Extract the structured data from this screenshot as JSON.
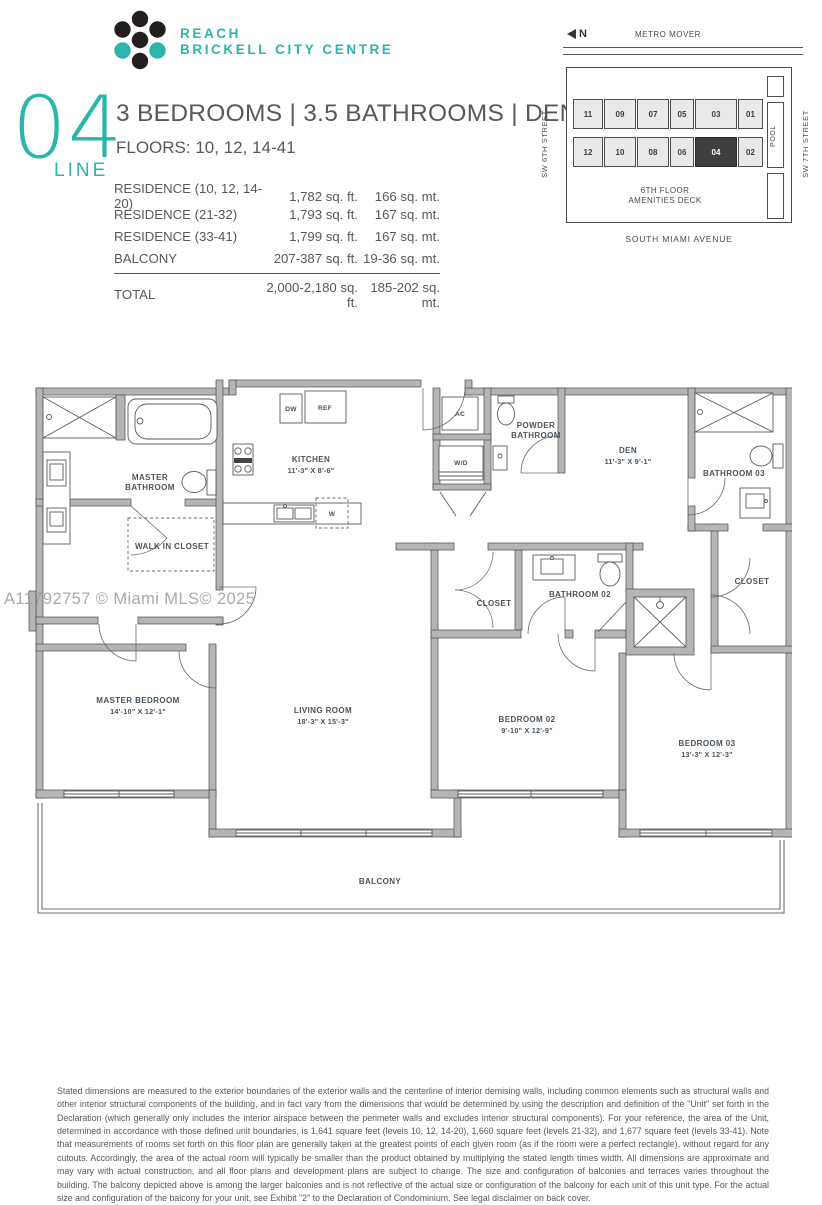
{
  "brand": {
    "line1": "REACH",
    "line2": "BRICKELL CITY CENTRE"
  },
  "header": {
    "line_number": "04",
    "line_label": "LINE",
    "title": "3 BEDROOMS  |  3.5 BATHROOMS  |  DEN",
    "floors": "FLOORS: 10, 12, 14-41"
  },
  "area_table": {
    "rows": [
      {
        "label": "RESIDENCE (10, 12, 14-20)",
        "sqft": "1,782 sq. ft.",
        "sqmt": "166 sq. mt."
      },
      {
        "label": "RESIDENCE (21-32)",
        "sqft": "1,793 sq. ft.",
        "sqmt": "167 sq. mt."
      },
      {
        "label": "RESIDENCE (33-41)",
        "sqft": "1,799 sq. ft.",
        "sqmt": "167 sq. mt."
      },
      {
        "label": "BALCONY",
        "sqft": "207-387 sq. ft.",
        "sqmt": "19-36 sq. mt."
      }
    ],
    "total": {
      "label": "TOTAL",
      "sqft": "2,000-2,180 sq. ft.",
      "sqmt": "185-202 sq. mt."
    }
  },
  "site_map": {
    "north": "N",
    "metro": "METRO MOVER",
    "street_left": "SW 6TH STREET",
    "street_right": "SW 7TH STREET",
    "avenue": "SOUTH MIAMI AVENUE",
    "pool": "POOL",
    "amenities_1": "6TH  FLOOR",
    "amenities_2": "AMENITIES DECK",
    "top_units": [
      "11",
      "09",
      "07",
      "05",
      "03",
      "01"
    ],
    "bottom_units": [
      "12",
      "10",
      "08",
      "06",
      "04",
      "02"
    ],
    "highlighted_unit": "04"
  },
  "plan": {
    "master_bathroom_1": "MASTER",
    "master_bathroom_2": "BATHROOM",
    "walk_in_closet": "WALK IN CLOSET",
    "kitchen": "KITCHEN",
    "kitchen_dims": "11'-3\" X 8'-6\"",
    "dw": "DW",
    "ref": "REF",
    "ac": "AC",
    "wd": "W/D",
    "w": "W",
    "powder_1": "POWDER",
    "powder_2": "BATHROOM",
    "den": "DEN",
    "den_dims": "11'-3\" X 9'-1\"",
    "bathroom03": "BATHROOM 03",
    "closet_right": "CLOSET",
    "bathroom02": "BATHROOM 02",
    "closet_left": "CLOSET",
    "master_bedroom": "MASTER BEDROOM",
    "master_bedroom_dims": "14'-10\" X 12'-1\"",
    "living_room": "LIVING ROOM",
    "living_room_dims": "18'-3\" X 15'-3\"",
    "bedroom02": "BEDROOM 02",
    "bedroom02_dims": "9'-10\" X 12'-9\"",
    "bedroom03": "BEDROOM 03",
    "bedroom03_dims": "13'-3\" X 12'-3\"",
    "balcony": "BALCONY"
  },
  "watermark": "A11792757 © Miami MLS© 2025",
  "disclaimer": "Stated dimensions are measured to the exterior boundaries of the exterior walls and the centerline of interior demising walls, including common elements such as structural walls and other interior structural components of the building, and in fact vary from the dimensions that would be determined by using the description and definition of the \"Unit\" set forth in the Declaration (which generally only includes the interior airspace between the perimeter walls and excludes interior structural components). For your reference, the area of the Unit, determined in accordance with those defined unit boundaries, is 1,641 square feet (levels 10, 12, 14-20), 1,660 square feet (levels 21-32), and 1,677 square feet (levels 33-41). Note that measurements of rooms set forth on this floor plan are generally taken at the greatest points of each given room (as if the room were a perfect rectangle), without regard for any cutouts. Accordingly, the area of the actual room will typically be smaller than the product obtained by multiplying the stated length times width. All dimensions are approximate and may vary with actual construction, and all floor plans and development plans are subject to change. The size and configuration of balconies and terraces varies throughout the building. The balcony depicted above is among the larger balconies and is not reflective of the actual size or configuration of the balcony for each unit of this unit type. For the actual size and configuration of the balcony for your unit, see Exhibit \"2\" to the Declaration of Condominium. See legal disclaimer on back cover."
}
